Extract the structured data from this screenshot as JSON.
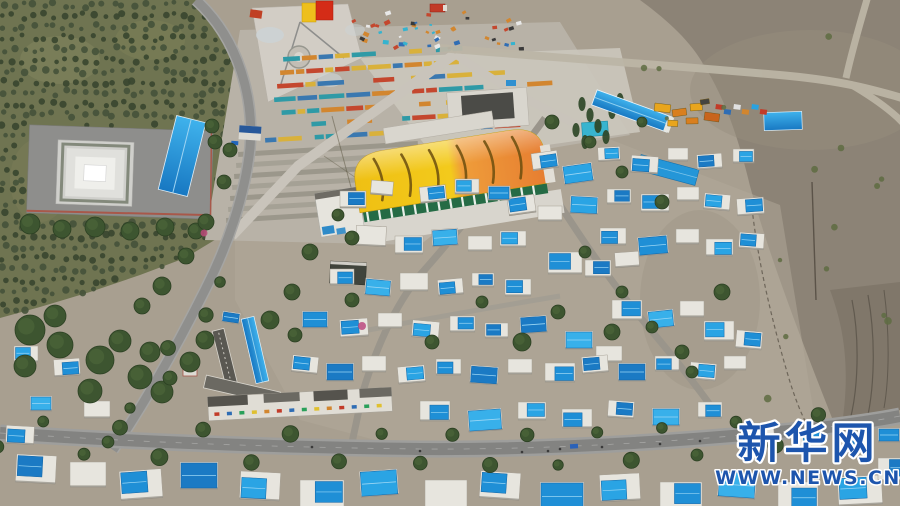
{
  "meta": {
    "type": "aerial-drone-photograph",
    "subject": "Aerial view of a plateau township: dense village of white courtyard houses with bright blue metal roofs, a tree-lined main road, an orchard grove with a white monument compound, a construction site with rows of colorful materials, and a large arched trade-market building with a yellow and orange roof, surrounded by barren grey-brown hills",
    "source_watermark": "Xinhua Net"
  },
  "watermark": {
    "logo": "新华网",
    "url": "WWW.NEWS.CN",
    "color": "#1d55ad",
    "outline": "#ffffff"
  },
  "palette": {
    "ground": "#a89f90",
    "hillside": "#8c8376",
    "orchard": "#6f7451",
    "road_asphalt": "#838381",
    "dirt_road": "#bcb5a5",
    "house_wall": "#e7e5de",
    "roof_blues": [
      "#1f8fd6",
      "#2aa4e4",
      "#1b7ac4",
      "#38b0ea"
    ],
    "market_roof_yellow": "#f3ca1c",
    "market_roof_orange": "#e67d31",
    "market_wall_green": "#256b45",
    "tree_green": "#3a5430",
    "flag_yellow": "#eebf1c",
    "flag_red": "#d42c17"
  },
  "regions": [
    "orchard-grove",
    "monument-compound",
    "construction-site",
    "market-building",
    "equipment-yard",
    "village-houses",
    "main-road",
    "barren-hillside"
  ]
}
